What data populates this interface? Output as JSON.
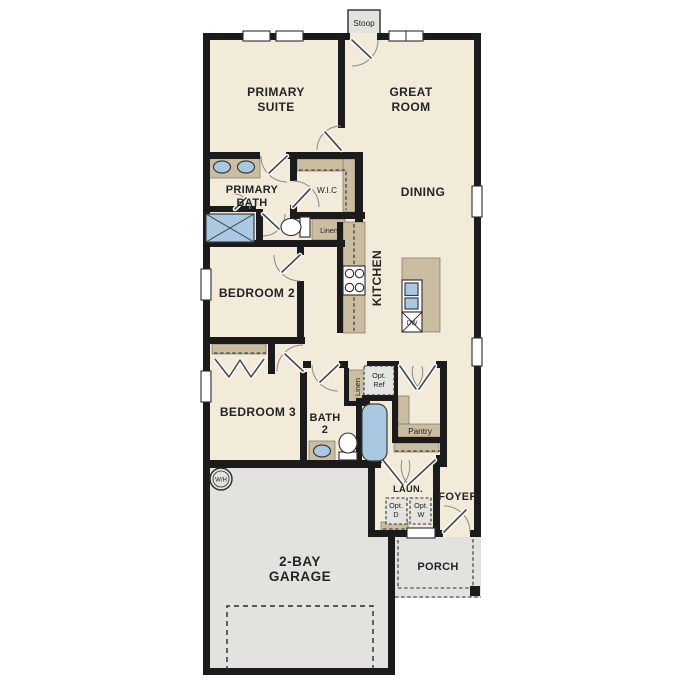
{
  "plan_type": "single-story-floor-plan",
  "colors": {
    "background": "#ffffff",
    "floor": "#f2ebda",
    "concrete": "#e3e2de",
    "wall": "#1b1b1b",
    "cabinet": "#cbbda0",
    "fixture_blue": "#a9c9e2",
    "label_text": "#242424"
  },
  "labels": {
    "stoop": "Stoop",
    "primary_suite_1": "PRIMARY",
    "primary_suite_2": "SUITE",
    "great_room_1": "GREAT",
    "great_room_2": "ROOM",
    "primary_bath_1": "PRIMARY",
    "primary_bath_2": "BATH",
    "wic": "W.I.C",
    "dining": "DINING",
    "kitchen": "KITCHEN",
    "linen_bath1": "Linen",
    "bedroom2": "BEDROOM 2",
    "bedroom3": "BEDROOM 3",
    "bath2_1": "BATH",
    "bath2_2": "2",
    "linen_hall": "Linen",
    "opt_ref_1": "Opt.",
    "opt_ref_2": "Ref",
    "pantry": "Pantry",
    "laundry": "LAUN.",
    "foyer": "FOYER",
    "opt_d_1": "Opt.",
    "opt_d_2": "D",
    "opt_w_1": "Opt.",
    "opt_w_2": "W",
    "porch": "PORCH",
    "garage_1": "2-BAY",
    "garage_2": "GARAGE",
    "water_heater": "W/H",
    "dishwasher": "DW"
  }
}
